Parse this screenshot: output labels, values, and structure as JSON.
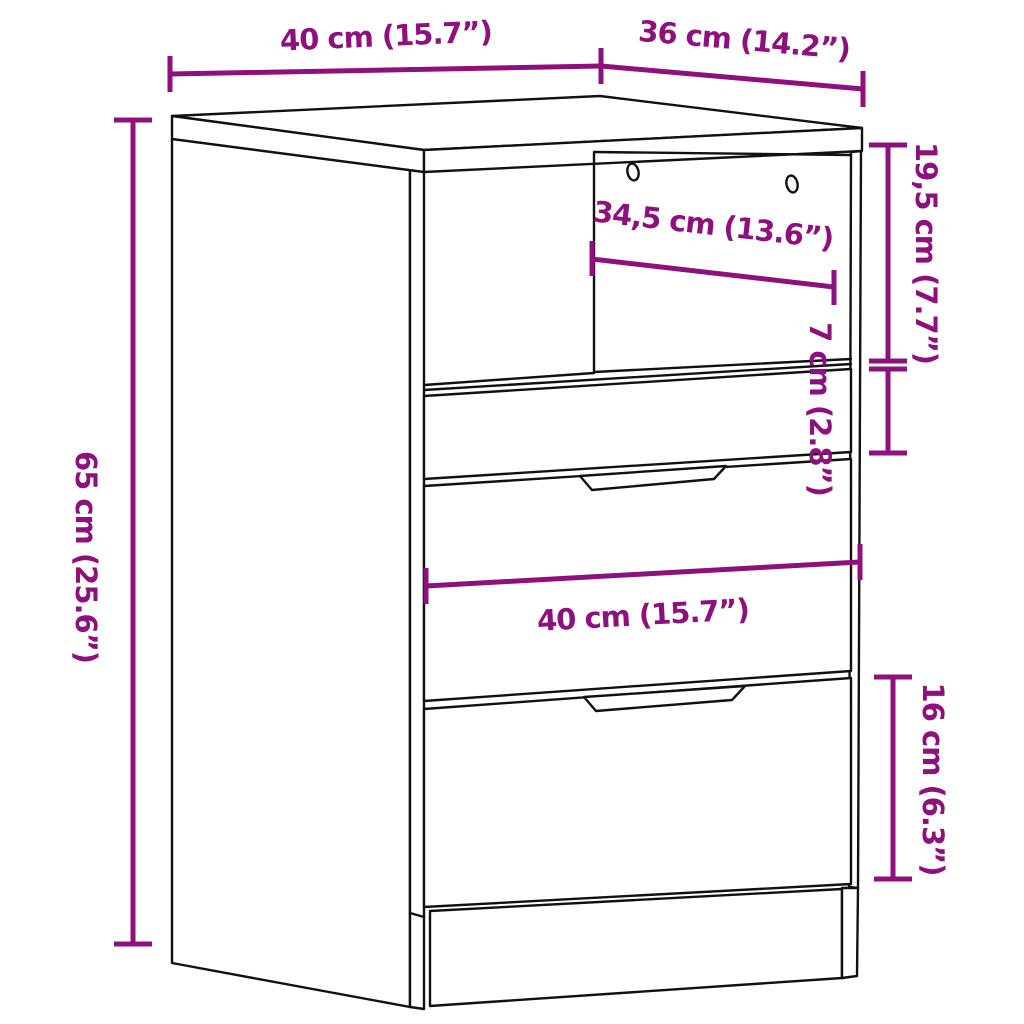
{
  "title": "Cabinet with drawers – dimension diagram",
  "colors": {
    "dimension_accent": "#8e107c",
    "outline": "#111111",
    "background": "#ffffff"
  },
  "dimensions": {
    "top_width": "40 cm (15.7”)",
    "top_depth": "36 cm (14.2”)",
    "overall_height": "65 cm (25.6”)",
    "compartment_height": "19,5 cm (7.7”)",
    "small_drawer_height": "7 cm (2.8”)",
    "compartment_inner_width": "34,5 cm (13.6”)",
    "front_width": "40 cm (15.7”)",
    "bottom_drawer_height": "16 cm (6.3”)"
  }
}
